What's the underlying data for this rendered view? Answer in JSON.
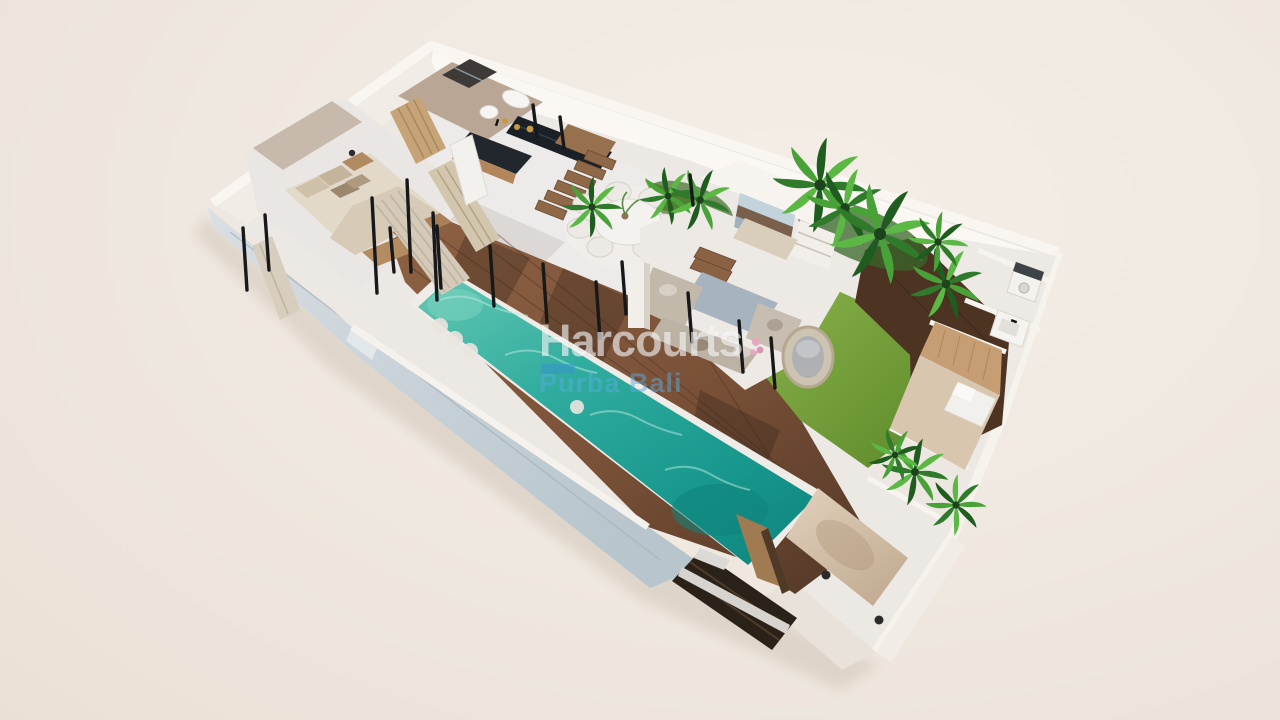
{
  "meta": {
    "description": "3D isometric floor plan render of a single-storey tropical villa with swimming pool, timber deck, garden and carport, presented on a plain beige backdrop",
    "render_type": "3D floor plan"
  },
  "watermark": {
    "brand": "Harcourts",
    "sub_brand": "Purba Bali",
    "brand_color": "rgba(255,255,255,0.58)",
    "sub_brand_color": "#58ACDE",
    "swoosh_color": "#3494CC"
  },
  "palette": {
    "background_beige": "#F0E9E1",
    "wall_white": "#F8F5F1",
    "exterior_wall_blue_gray": "#C3CED6",
    "interior_floor": "#ECE9E6",
    "pool_teal": "#2AA89B",
    "pool_deep_teal": "#108D85",
    "deck_brown": "#7B5238",
    "grass_green": "#7BAA3E",
    "palm_green": "#2F7A2B",
    "bed_linen": "#E3D9C9",
    "sofa_greige": "#C3B9AB",
    "kitchen_counter_dark": "#1E242C",
    "wood_cabinet": "#B3855A",
    "entrance_step_dark": "#2A2017"
  },
  "rooms": [
    {
      "name": "master-bedroom"
    },
    {
      "name": "ensuite-bathroom"
    },
    {
      "name": "wardrobe"
    },
    {
      "name": "kitchen"
    },
    {
      "name": "staircase"
    },
    {
      "name": "dining-area"
    },
    {
      "name": "sunken-living-room"
    },
    {
      "name": "garden"
    },
    {
      "name": "swimming-pool"
    },
    {
      "name": "pool-deck"
    },
    {
      "name": "utility-room"
    },
    {
      "name": "bathroom-2"
    },
    {
      "name": "bedroom-2"
    },
    {
      "name": "carport"
    },
    {
      "name": "entrance-stairs"
    }
  ]
}
